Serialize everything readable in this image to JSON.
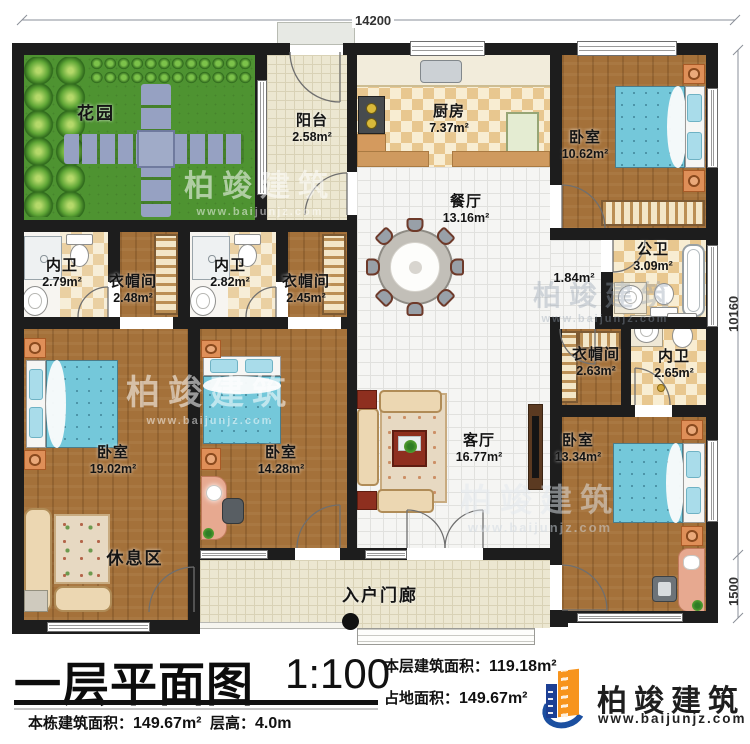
{
  "dimensions": {
    "top": "14200",
    "right_upper": "10160",
    "right_lower": "1500"
  },
  "rooms": {
    "garden": {
      "name": "花园"
    },
    "balcony": {
      "name": "阳台",
      "area": "2.58m²"
    },
    "kitchen": {
      "name": "厨房",
      "area": "7.37m²"
    },
    "bedroom_tr": {
      "name": "卧室",
      "area": "10.62m²"
    },
    "dining": {
      "name": "餐厅",
      "area": "13.16m²"
    },
    "bath_l1": {
      "name": "内卫",
      "area": "2.79m²"
    },
    "cloak_l1": {
      "name": "衣帽间",
      "area": "2.48m²"
    },
    "bath_l2": {
      "name": "内卫",
      "area": "2.82m²"
    },
    "cloak_l2": {
      "name": "衣帽间",
      "area": "2.45m²"
    },
    "public_bath": {
      "name": "公卫",
      "area": "3.09m²"
    },
    "hall": {
      "area": "1.84m²"
    },
    "cloak_r": {
      "name": "衣帽间",
      "area": "2.63m²"
    },
    "bath_r": {
      "name": "内卫",
      "area": "2.65m²"
    },
    "bedroom_bl": {
      "name": "卧室",
      "area": "19.02m²"
    },
    "rest_area": {
      "name": "休息区"
    },
    "bedroom_bm": {
      "name": "卧室",
      "area": "14.28m²"
    },
    "living": {
      "name": "客厅",
      "area": "16.77m²"
    },
    "bedroom_br": {
      "name": "卧室",
      "area": "13.34m²"
    },
    "porch": {
      "name": "入户门廊"
    }
  },
  "title_block": {
    "title": "一层平面图",
    "scale": "1:100",
    "floor_area_label": "本层建筑面积：",
    "floor_area_value": "119.18m²",
    "land_area_label": "占地面积：",
    "land_area_value": "149.67m²",
    "building_area_label": "本栋建筑面积：",
    "building_area_value": "149.67m²",
    "height_label": "层高：",
    "height_value": "4.0m"
  },
  "branding": {
    "company": "柏竣建筑",
    "website": "www.baijunjz.com"
  },
  "watermark": {
    "company": "柏竣建筑",
    "website": "www.baijunjz.com"
  },
  "colors": {
    "wall": "#1d1d1d",
    "grass": "#4e9331",
    "wood": "#a4713a",
    "bed": "#74c8da",
    "logo_orange": "#f7941d",
    "logo_blue": "#1c3f94"
  }
}
